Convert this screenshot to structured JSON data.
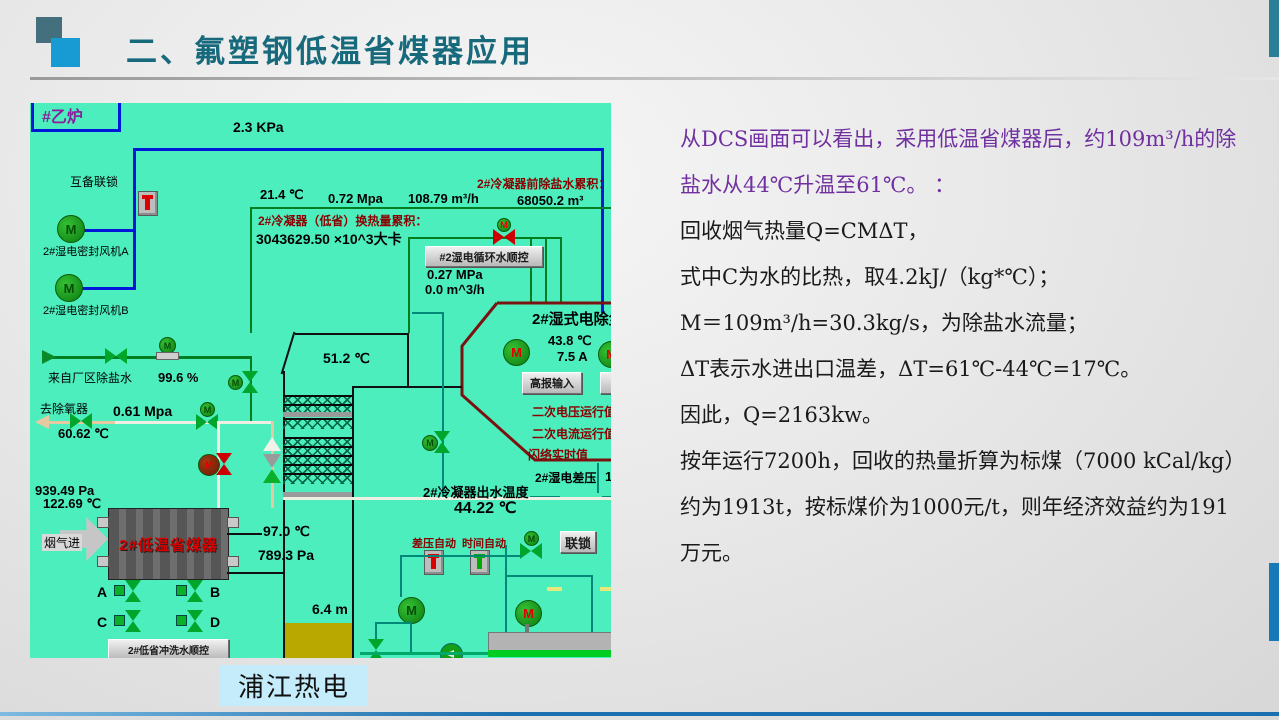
{
  "slide": {
    "title": "二、氟塑钢低温省煤器应用",
    "caption": "浦江热电"
  },
  "colors": {
    "title_teal": "#17697C",
    "accent_blue": "#189BD3",
    "dcs_background": "#4DEEBE",
    "purple_text": "#7030A0",
    "maroon_label": "#8B0000",
    "alarm_red": "#CC0000",
    "pipe_blue": "#0016D8",
    "pipe_green": "#007D1F",
    "tank_fill_olive": "#B8A800"
  },
  "analysis": {
    "intro": "从DCS画面可以看出，采用低温省煤器后，约109m³/h的除盐水从44℃升温至61℃。 ：",
    "lines": [
      "回收烟气热量Q=CMΔT，",
      "式中C为水的比热，取4.2kJ/（kg*℃）；",
      "M＝109m³/h=30.3kg/s，为除盐水流量；",
      "ΔT表示水进出口温差，ΔT=61℃-44℃=17℃。",
      "因此，Q=2163kw。",
      "按年运行7200h，回收的热量折算为标煤（7000 kCal/kg）约为1913t，按标煤价为1000元/t，则年经济效益约为191万元。"
    ]
  },
  "dcs": {
    "motor_letter": "M",
    "labels": {
      "boiler": "#乙炉",
      "p_top": "2.3 KPa",
      "interlock": "互备联锁",
      "fan_a": "2#湿电密封风机A",
      "fan_b": "2#湿电密封风机B",
      "t_21": "21.4 ℃",
      "p_072": "0.72 Mpa",
      "f_108": "108.79 m³/h",
      "acc_water_label": "2#冷凝器前除盐水累积：",
      "acc_water_value": "68050.2 m³",
      "acc_heat_label": "2#冷凝器（低省）换热量累积：",
      "acc_heat_value": "3043629.50 ×10^3大卡",
      "btn_circ": "#2湿电循环水顺控",
      "p_027": "0.27 MPa",
      "f_00": "0.0 m^3/h",
      "esp_title": "2#湿式电除尘",
      "t_438": "43.8 ℃",
      "a_75": "7.5 A",
      "btn_alarm": "高报输入",
      "sec_v": "二次电压运行值",
      "sec_i": "二次电流运行值",
      "flash": "闪络实时值",
      "dp_label": "2#湿电差压",
      "dp_val": "1",
      "t_512": "51.2 ℃",
      "inlet": "来自厂区除盐水",
      "pct": "99.6 %",
      "deaer": "去除氧器",
      "p_061": "0.61 Mpa",
      "t_6062": "60.62 ℃",
      "p_939": "939.49 Pa",
      "t_1226": "122.69 ℃",
      "flue": "烟气进",
      "eco": "2#低温省煤器",
      "t_97": "97.0 ℃",
      "p_789": "789.3 Pa",
      "out_t_label": "2#冷凝器出水温度",
      "out_t_val": "44.22 ℃",
      "va": "A",
      "vb": "B",
      "vc": "C",
      "vd": "D",
      "btn_purge": "2#低省冲洗水顺控",
      "auto_dp": "差压自动",
      "auto_time": "时间自动",
      "btn_lock": "联锁",
      "level": "6.4 m"
    }
  }
}
